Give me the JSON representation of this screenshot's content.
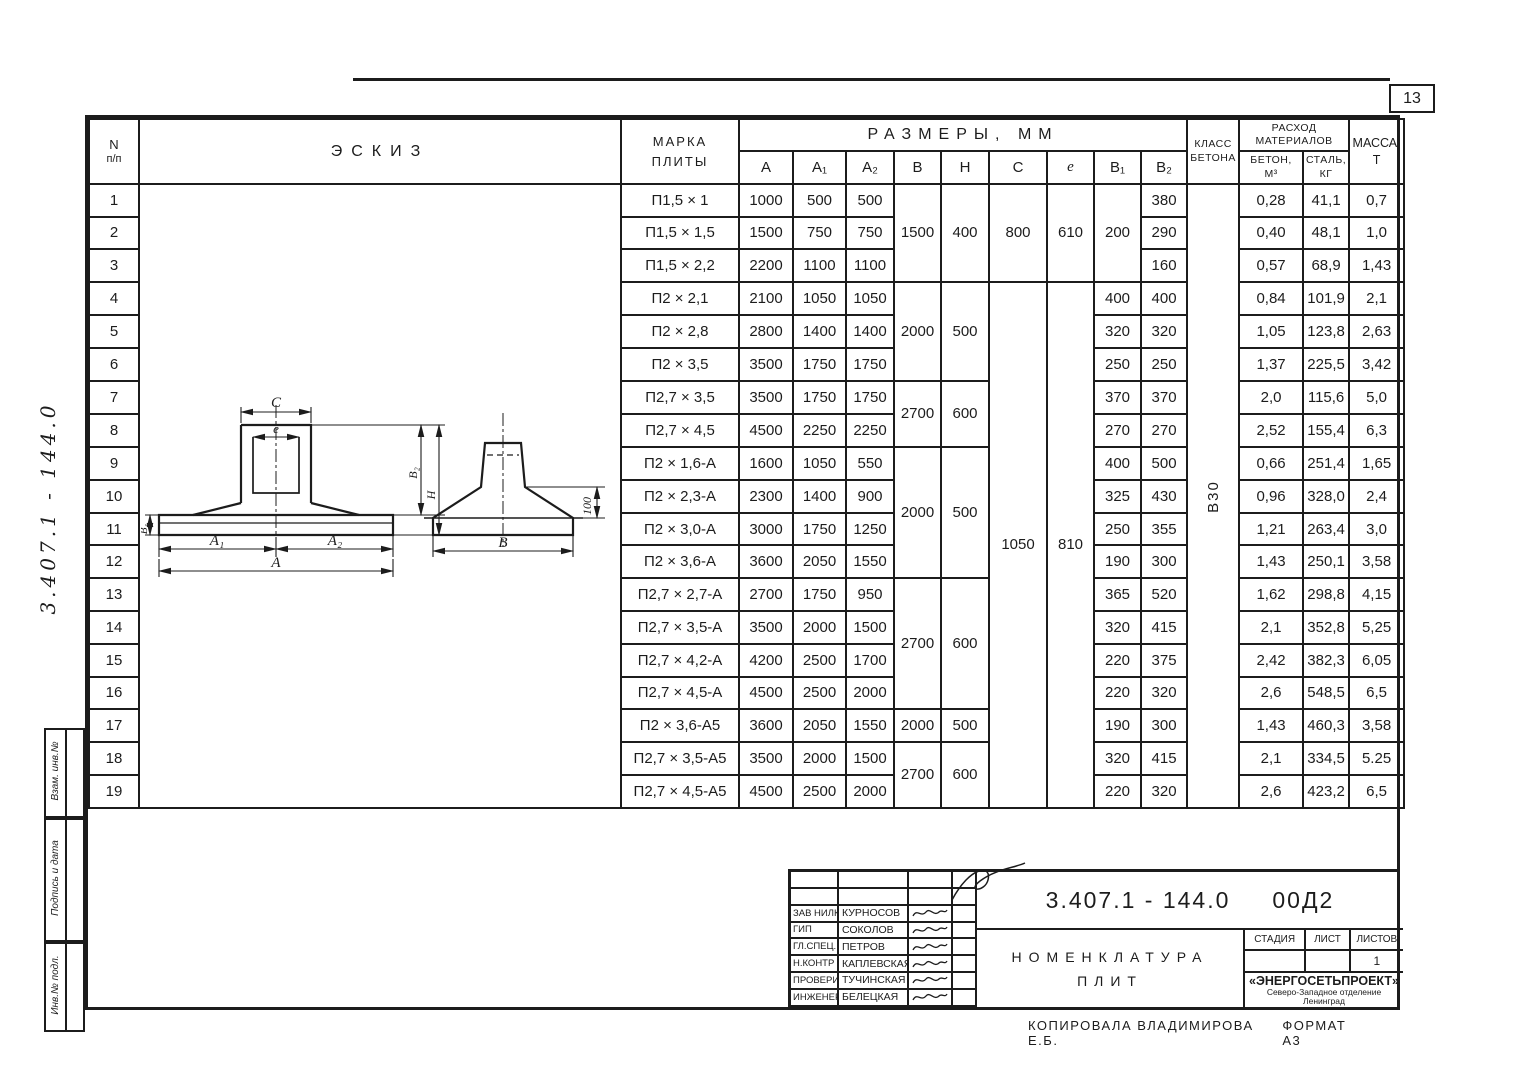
{
  "page": {
    "number": "13",
    "doc_number_vertical": "3.407.1 - 144.0",
    "footer_copied": "Копировала  Владимирова Е.Б.",
    "footer_format": "формат А3"
  },
  "stamps": {
    "vzam": "Взам. инв.№",
    "podpis": "Подпись и дата",
    "inv": "Инв.№ подл."
  },
  "header": {
    "n": "N",
    "np": "п/п",
    "eskiz": "Эскиз",
    "mark1": "Марка",
    "mark2": "плиты",
    "razmery": "Размеры,  мм",
    "klass1": "Класс",
    "klass2": "бетона",
    "rashod1": "Расход",
    "rashod2": "материалов",
    "beton1": "Бетон,",
    "beton2": "м³",
    "stal1": "Сталь,",
    "stal2": "кг",
    "massa1": "Масса,",
    "massa2": "т",
    "cols": {
      "a": "A",
      "a1": "A₁",
      "a2": "A₂",
      "b": "B",
      "h": "H",
      "c": "C",
      "e": "e",
      "b1": "B₁",
      "b2": "B₂"
    }
  },
  "sketch": {
    "dims": {
      "c": "C",
      "e": "e",
      "b1": "B₁",
      "b2": "B₂",
      "h": "H",
      "a1": "A₁",
      "a2": "A₂",
      "a": "A",
      "b": "B",
      "edge": "100"
    }
  },
  "table": {
    "concrete_class": "В30",
    "rows": [
      {
        "n": "1",
        "mark": "П1,5 × 1",
        "a": "1000",
        "a1": "500",
        "a2": "500",
        "b": {
          "v": "1500",
          "rs": 3
        },
        "h": {
          "v": "400",
          "rs": 3
        },
        "c": {
          "v": "800",
          "rs": 3
        },
        "e": {
          "v": "610",
          "rs": 3
        },
        "b1": {
          "v": "200",
          "rs": 3
        },
        "b2": "380",
        "klass": {
          "v": "В30",
          "rs": 19
        },
        "beton": "0,28",
        "stal": "41,1",
        "massa": "0,7"
      },
      {
        "n": "2",
        "mark": "П1,5 × 1,5",
        "a": "1500",
        "a1": "750",
        "a2": "750",
        "b2": "290",
        "beton": "0,40",
        "stal": "48,1",
        "massa": "1,0"
      },
      {
        "n": "3",
        "mark": "П1,5 × 2,2",
        "a": "2200",
        "a1": "1100",
        "a2": "1100",
        "b2": "160",
        "beton": "0,57",
        "stal": "68,9",
        "massa": "1,43"
      },
      {
        "n": "4",
        "mark": "П2 × 2,1",
        "a": "2100",
        "a1": "1050",
        "a2": "1050",
        "b": {
          "v": "2000",
          "rs": 3
        },
        "h": {
          "v": "500",
          "rs": 3
        },
        "c": {
          "v": "1050",
          "rs": 16
        },
        "e": {
          "v": "810",
          "rs": 16
        },
        "b1": "400",
        "b2": "400",
        "beton": "0,84",
        "stal": "101,9",
        "massa": "2,1"
      },
      {
        "n": "5",
        "mark": "П2 × 2,8",
        "a": "2800",
        "a1": "1400",
        "a2": "1400",
        "b1": "320",
        "b2": "320",
        "beton": "1,05",
        "stal": "123,8",
        "massa": "2,63"
      },
      {
        "n": "6",
        "mark": "П2 × 3,5",
        "a": "3500",
        "a1": "1750",
        "a2": "1750",
        "b1": "250",
        "b2": "250",
        "beton": "1,37",
        "stal": "225,5",
        "massa": "3,42"
      },
      {
        "n": "7",
        "mark": "П2,7 × 3,5",
        "a": "3500",
        "a1": "1750",
        "a2": "1750",
        "b": {
          "v": "2700",
          "rs": 2
        },
        "h": {
          "v": "600",
          "rs": 2
        },
        "b1": "370",
        "b2": "370",
        "beton": "2,0",
        "stal": "115,6",
        "massa": "5,0"
      },
      {
        "n": "8",
        "mark": "П2,7 × 4,5",
        "a": "4500",
        "a1": "2250",
        "a2": "2250",
        "b1": "270",
        "b2": "270",
        "beton": "2,52",
        "stal": "155,4",
        "massa": "6,3"
      },
      {
        "n": "9",
        "mark": "П2 × 1,6-А",
        "a": "1600",
        "a1": "1050",
        "a2": "550",
        "b": {
          "v": "2000",
          "rs": 4
        },
        "h": {
          "v": "500",
          "rs": 4
        },
        "b1": "400",
        "b2": "500",
        "beton": "0,66",
        "stal": "251,4",
        "massa": "1,65"
      },
      {
        "n": "10",
        "mark": "П2 × 2,3-А",
        "a": "2300",
        "a1": "1400",
        "a2": "900",
        "b1": "325",
        "b2": "430",
        "beton": "0,96",
        "stal": "328,0",
        "massa": "2,4"
      },
      {
        "n": "11",
        "mark": "П2 × 3,0-А",
        "a": "3000",
        "a1": "1750",
        "a2": "1250",
        "b1": "250",
        "b2": "355",
        "beton": "1,21",
        "stal": "263,4",
        "massa": "3,0"
      },
      {
        "n": "12",
        "mark": "П2 × 3,6-А",
        "a": "3600",
        "a1": "2050",
        "a2": "1550",
        "b1": "190",
        "b2": "300",
        "beton": "1,43",
        "stal": "250,1",
        "massa": "3,58"
      },
      {
        "n": "13",
        "mark": "П2,7 × 2,7-А",
        "a": "2700",
        "a1": "1750",
        "a2": "950",
        "b": {
          "v": "2700",
          "rs": 4
        },
        "h": {
          "v": "600",
          "rs": 4
        },
        "b1": "365",
        "b2": "520",
        "beton": "1,62",
        "stal": "298,8",
        "massa": "4,15"
      },
      {
        "n": "14",
        "mark": "П2,7 × 3,5-А",
        "a": "3500",
        "a1": "2000",
        "a2": "1500",
        "b1": "320",
        "b2": "415",
        "beton": "2,1",
        "stal": "352,8",
        "massa": "5,25"
      },
      {
        "n": "15",
        "mark": "П2,7 × 4,2-А",
        "a": "4200",
        "a1": "2500",
        "a2": "1700",
        "b1": "220",
        "b2": "375",
        "beton": "2,42",
        "stal": "382,3",
        "massa": "6,05"
      },
      {
        "n": "16",
        "mark": "П2,7 × 4,5-А",
        "a": "4500",
        "a1": "2500",
        "a2": "2000",
        "b1": "220",
        "b2": "320",
        "beton": "2,6",
        "stal": "548,5",
        "massa": "6,5"
      },
      {
        "n": "17",
        "mark": "П2 × 3,6-А5",
        "a": "3600",
        "a1": "2050",
        "a2": "1550",
        "b": "2000",
        "h": "500",
        "b1": "190",
        "b2": "300",
        "beton": "1,43",
        "stal": "460,3",
        "massa": "3,58"
      },
      {
        "n": "18",
        "mark": "П2,7 × 3,5-А5",
        "a": "3500",
        "a1": "2000",
        "a2": "1500",
        "b": {
          "v": "2700",
          "rs": 2
        },
        "h": {
          "v": "600",
          "rs": 2
        },
        "b1": "320",
        "b2": "415",
        "beton": "2,1",
        "stal": "334,5",
        "massa": "5.25"
      },
      {
        "n": "19",
        "mark": "П2,7 × 4,5-А5",
        "a": "4500",
        "a1": "2500",
        "a2": "2000",
        "b1": "220",
        "b2": "320",
        "beton": "2,6",
        "stal": "423,2",
        "massa": "6,5"
      }
    ]
  },
  "titleblock": {
    "doc_number": "3.407.1 - 144.0",
    "doc_suffix": "00Д2",
    "title_line1": "Номенклатура",
    "title_line2": "плит",
    "stage_label": "Стадия",
    "sheet_label": "Лист",
    "sheets_label": "Листов",
    "stage_value": "",
    "sheet_value": "",
    "sheets_value": "1",
    "org": "«ЭНЕРГОСЕТЬПРОЕКТ»",
    "org_branch": "Северо-Западное отделение",
    "org_city": "Ленинград",
    "sign_rows": [
      {
        "role": "",
        "name": ""
      },
      {
        "role": "",
        "name": ""
      },
      {
        "role": "Зав НИЛКЗ",
        "name": "Курносов"
      },
      {
        "role": "ГИП",
        "name": "Соколов"
      },
      {
        "role": "Гл.спец.",
        "name": "Петров"
      },
      {
        "role": "Н.контр",
        "name": "Каплевская"
      },
      {
        "role": "Проверила",
        "name": "Тучинская"
      },
      {
        "role": "Инженер",
        "name": "Белецкая"
      }
    ]
  }
}
